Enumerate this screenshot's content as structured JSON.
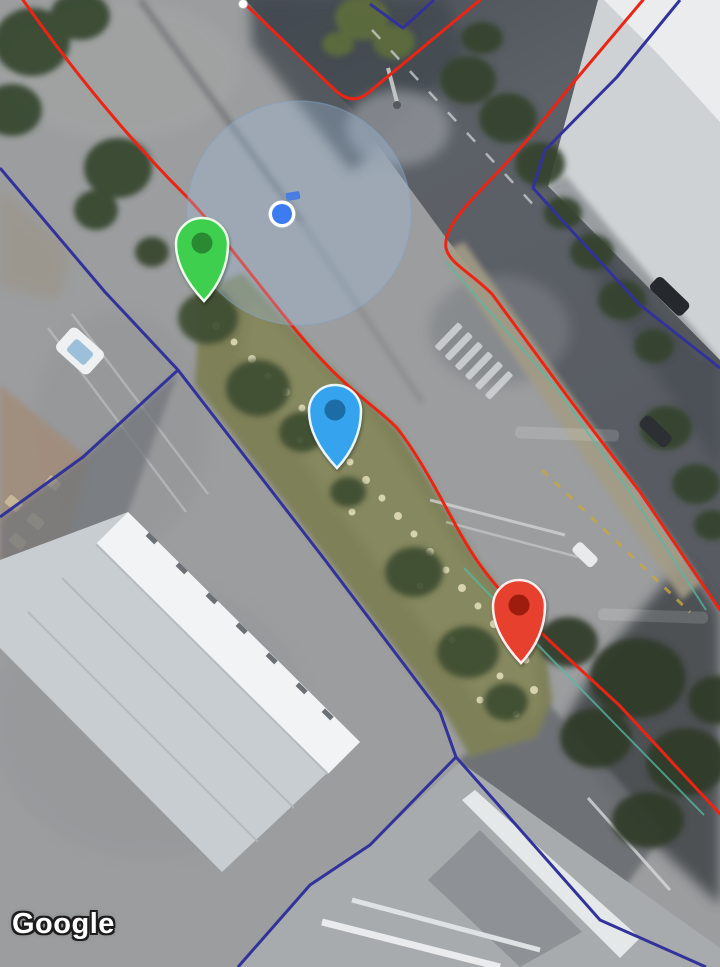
{
  "map": {
    "provider_watermark": "Google",
    "imagery_type": "satellite",
    "markers": {
      "green": {
        "body_color": "#3ecf4e",
        "inner_color": "#2b8a33",
        "outline_color": "#e9ffe9"
      },
      "blue": {
        "body_color": "#36a3ed",
        "inner_color": "#1d6ca5",
        "outline_color": "#e8f6ff"
      },
      "red": {
        "body_color": "#e7402e",
        "inner_color": "#9e1b10",
        "outline_color": "#ffecec"
      }
    },
    "location_indicator": {
      "dot_color": "#3d7bf0",
      "ring_color": "#ffffff",
      "heading_color": "#4a7de0",
      "accuracy_fill": "rgba(160,192,226,0.33)",
      "accuracy_stroke": "rgba(130,165,205,0.5)"
    },
    "overlay_lines": {
      "parcel_red": "#ec2414",
      "parcel_navy": "#32329b",
      "curb_teal": "#55b9a5",
      "vertex_dot_fill": "#ffffff"
    }
  }
}
